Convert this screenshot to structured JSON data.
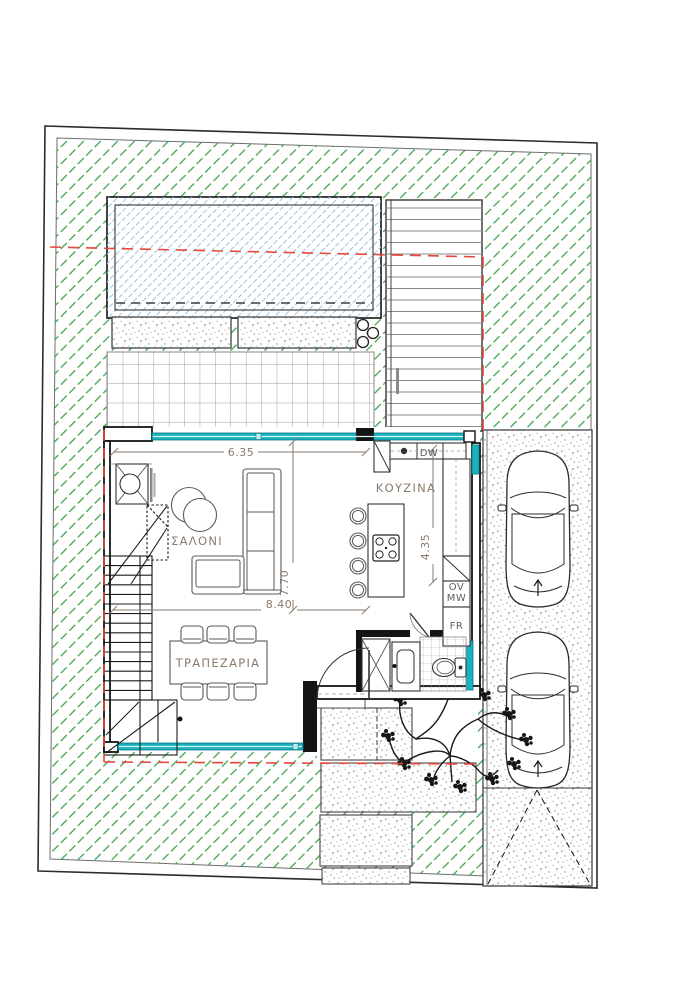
{
  "plan_labels": {
    "living": "ΣΑΛΟΝΙ",
    "dining": "ΤΡΑΠΕΖΑΡΙΑ",
    "kitchen": "ΚΟΥΖΙΝΑ"
  },
  "appliance_labels": {
    "dishwasher": "DW",
    "oven": "OV",
    "microwave": "MW",
    "fridge": "FR"
  },
  "dimensions": {
    "living_width": "6.35",
    "living_depth": "7.70",
    "house_width": "8.40",
    "kitchen_depth": "4.35"
  },
  "colors": {
    "garden-hatch": "#3aa048",
    "pool-hatch": "#99c5e6",
    "glazing": "#19b2bf",
    "projection-red": "#e5483b",
    "label-text": "#8a7a6c",
    "wall": "#141414"
  }
}
